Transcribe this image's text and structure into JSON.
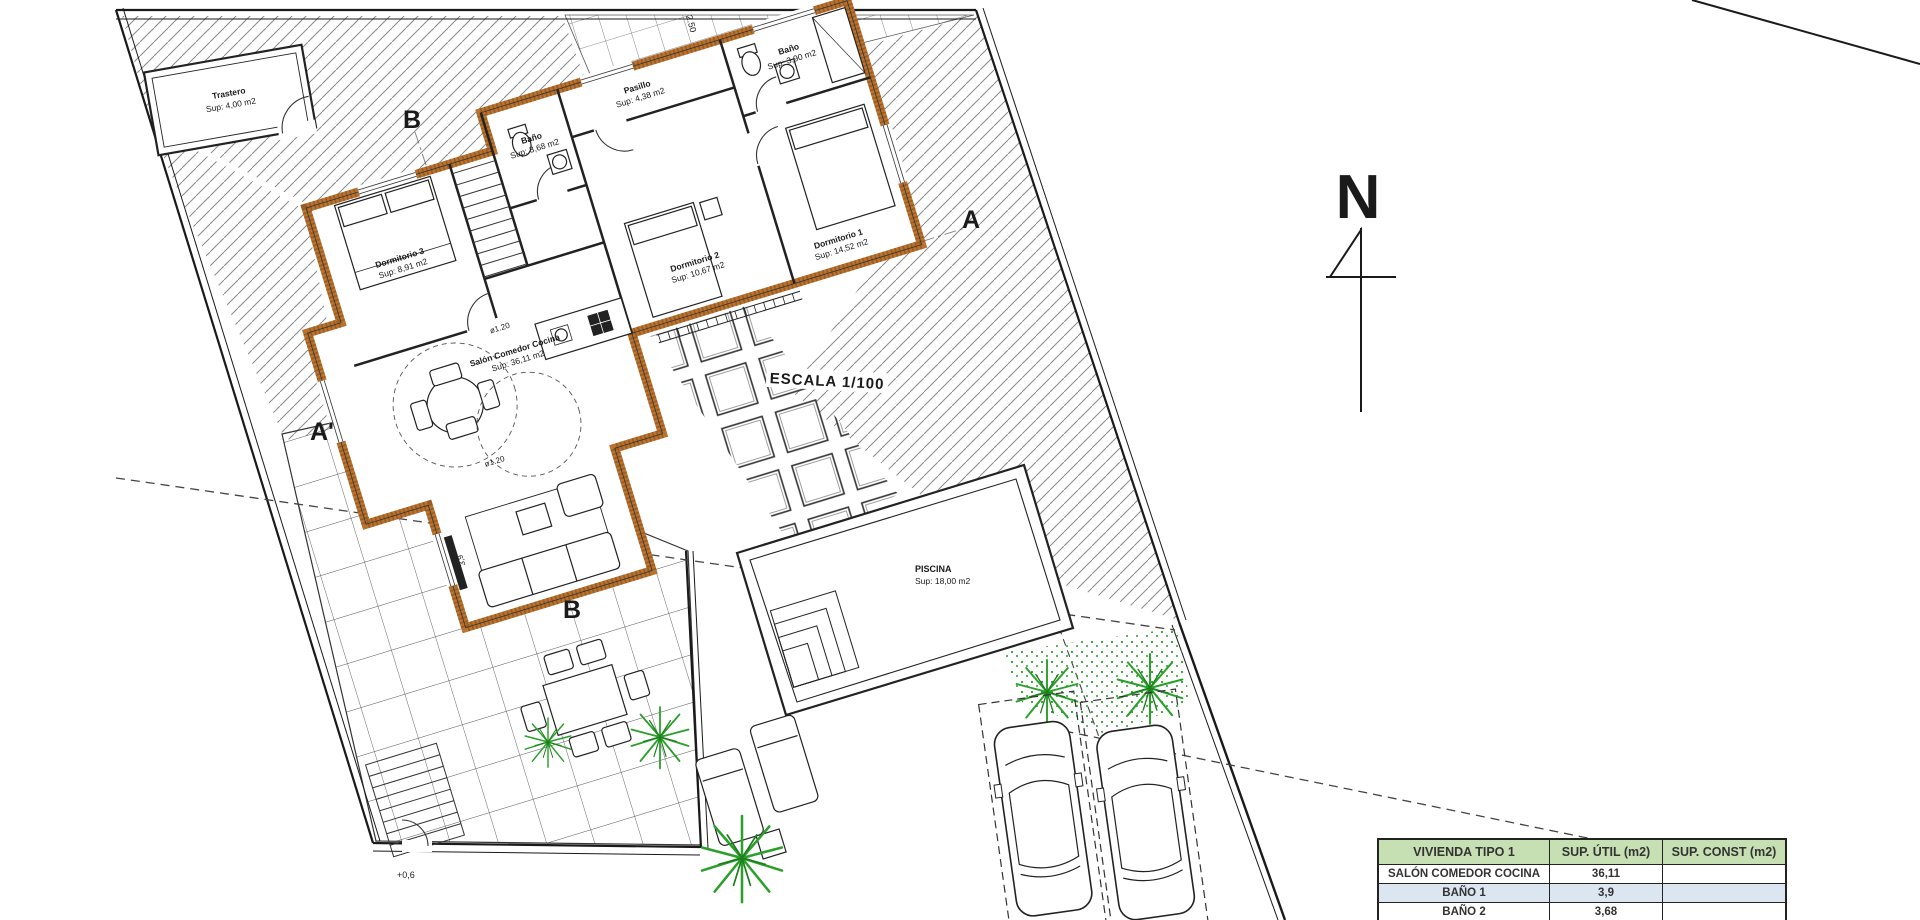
{
  "drawing": {
    "scale_label": "ESCALA 1/100",
    "north_label": "N",
    "dim_top": "2.50",
    "level_label": "+0,6",
    "sofa_dim": "3,9",
    "circle_label": "ø1.20",
    "section": {
      "a": "A",
      "a_prime": "A'",
      "b_top": "B",
      "b_bottom": "B"
    }
  },
  "rooms": {
    "trastero": {
      "name": "Trastero",
      "area": "Sup: 4,00 m2"
    },
    "dormitorio3": {
      "name": "Dormitorio 3",
      "area": "Sup: 8,91 m2"
    },
    "bano2": {
      "name": "Baño",
      "area": "Sup: 3,68 m2"
    },
    "pasillo": {
      "name": "Pasillo",
      "area": "Sup: 4,38 m2"
    },
    "bano1": {
      "name": "Baño",
      "area": "Sup: 3,90 m2"
    },
    "dormitorio2": {
      "name": "Dormitorio 2",
      "area": "Sup: 10,67 m2"
    },
    "dormitorio1": {
      "name": "Dormitorio 1",
      "area": "Sup: 14,52 m2"
    },
    "salon": {
      "name": "Salón Comedor Cocina",
      "area": "Sup: 36,11 m2"
    },
    "piscina": {
      "name": "PISCINA",
      "area": "Sup: 18,00 m2"
    }
  },
  "summary_table": {
    "headers": [
      "VIVIENDA TIPO 1",
      "SUP. ÚTIL (m2)",
      "SUP. CONST (m2)"
    ],
    "rows": [
      {
        "label": "SALÓN COMEDOR COCINA",
        "util": "36,11",
        "const": ""
      },
      {
        "label": "BAÑO 1",
        "util": "3,9",
        "const": ""
      },
      {
        "label": "BAÑO 2",
        "util": "3,68",
        "const": ""
      }
    ]
  },
  "colors": {
    "wall": "#b9732f",
    "wall_dark": "#7c4616",
    "table_header_bg": "#c6e0b4",
    "table_row_alt_bg": "#dce6f1",
    "vegetation": "#2aa02a"
  }
}
